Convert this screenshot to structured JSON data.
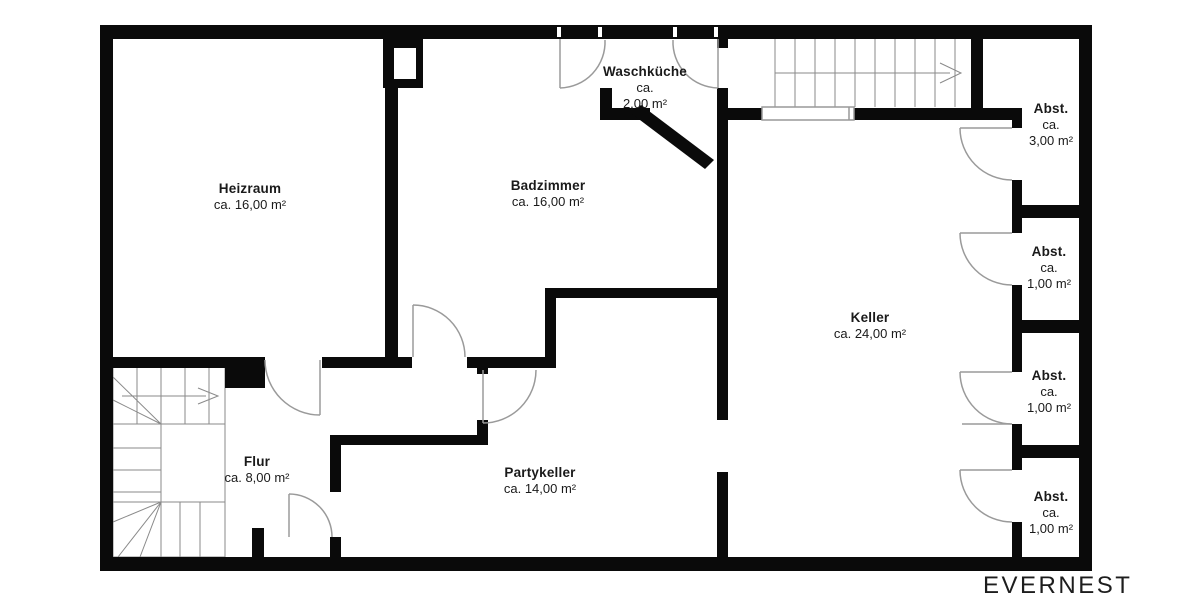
{
  "meta": {
    "plan_type": "basement floor plan",
    "background_color": "#ffffff",
    "wall_color": "#0a0a0a",
    "thin_line_color": "#8a8a8a",
    "text_color": "#1a1a1a"
  },
  "branding": {
    "logo_text": "EVERNEST"
  },
  "rooms": [
    {
      "id": "heizraum",
      "name": "Heizraum",
      "lines": [
        "ca. 16,00 m²"
      ],
      "cx": 250,
      "top": 181
    },
    {
      "id": "badzimmer",
      "name": "Badzimmer",
      "lines": [
        "ca. 16,00 m²"
      ],
      "cx": 548,
      "top": 178
    },
    {
      "id": "waschkueche",
      "name": "Waschküche",
      "lines": [
        "ca.",
        "2,00 m²"
      ],
      "cx": 645,
      "top": 64
    },
    {
      "id": "keller",
      "name": "Keller",
      "lines": [
        "ca. 24,00 m²"
      ],
      "cx": 870,
      "top": 310
    },
    {
      "id": "flur",
      "name": "Flur",
      "lines": [
        "ca. 8,00 m²"
      ],
      "cx": 257,
      "top": 454
    },
    {
      "id": "partykeller",
      "name": "Partykeller",
      "lines": [
        "ca. 14,00 m²"
      ],
      "cx": 540,
      "top": 465
    },
    {
      "id": "abst-1",
      "name": "Abst.",
      "lines": [
        "ca.",
        "3,00 m²"
      ],
      "cx": 1051,
      "top": 101
    },
    {
      "id": "abst-2",
      "name": "Abst.",
      "lines": [
        "ca.",
        "1,00 m²"
      ],
      "cx": 1049,
      "top": 244
    },
    {
      "id": "abst-3",
      "name": "Abst.",
      "lines": [
        "ca.",
        "1,00 m²"
      ],
      "cx": 1049,
      "top": 368
    },
    {
      "id": "abst-4",
      "name": "Abst.",
      "lines": [
        "ca.",
        "1,00 m²"
      ],
      "cx": 1051,
      "top": 489
    }
  ]
}
